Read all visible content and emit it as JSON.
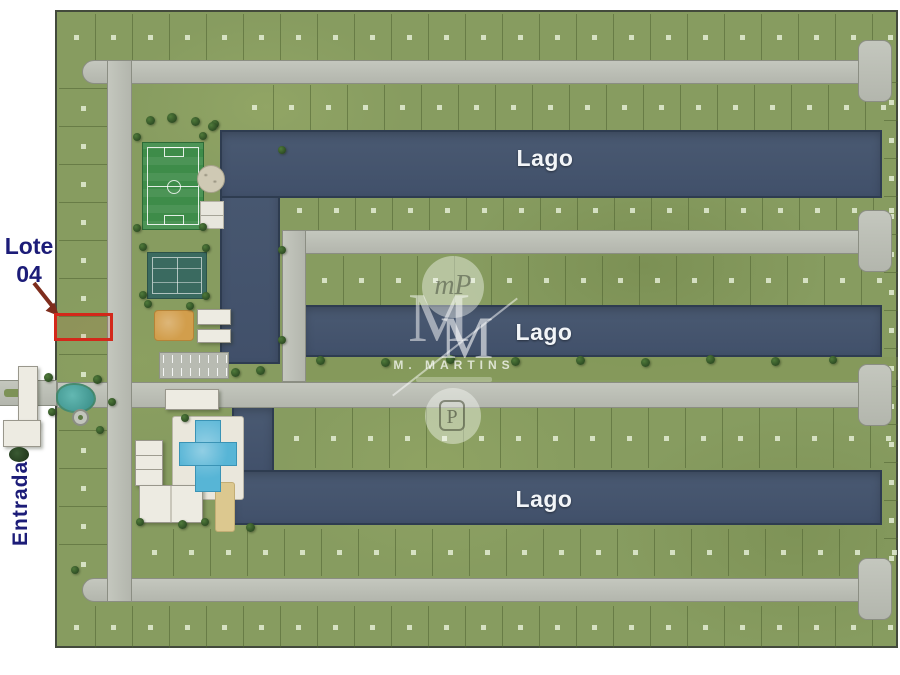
{
  "plan": {
    "region_labels": {
      "lago_top": "Lago",
      "lago_middle": "Lago",
      "lago_bottom": "Lago"
    }
  },
  "callout": {
    "line1": "Lote",
    "line2": "04"
  },
  "entrance_label": "Entrada",
  "watermark": {
    "circle_top_monogram": "mP",
    "monogram_letter_1": "M",
    "monogram_letter_2": "M",
    "brand_name": "M. MARTINS",
    "badge_letter": "P"
  },
  "colors": {
    "lot_green": "#879c60",
    "lake_blue": "#45536a",
    "road_gray": "#bcbfb6",
    "highlight_red": "#d3281a",
    "label_navy": "#1c1c78",
    "arrow_maroon": "#7e2d1d",
    "soccer_green": "#3e8c49",
    "court_teal": "#3a6a60",
    "pool_blue": "#57b5d6",
    "sand_tan": "#dcc88f",
    "playground_orange": "#d29e4c"
  }
}
